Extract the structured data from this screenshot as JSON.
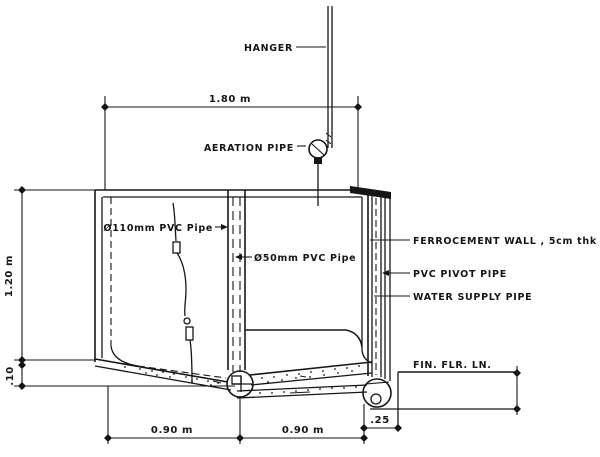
{
  "drawing": {
    "labels": {
      "hanger": "HANGER",
      "aeration_pipe": "AERATION PIPE",
      "pipe_110mm": "Ø110mm PVC Pipe",
      "pipe_50mm": "Ø50mm PVC Pipe",
      "ferrocement_wall": "FERROCEMENT WALL , 5cm thk",
      "pvc_pivot_pipe": "PVC PIVOT PIPE",
      "water_supply_pipe": "WATER SUPPLY PIPE",
      "finish_floor_line": "FIN. FLR. LN."
    },
    "dimensions": {
      "overall_width": "1.80 m",
      "tank_height": "1.20 m",
      "floor_drop": ".10",
      "left_half_width": "0.90 m",
      "right_half_width": "0.90 m",
      "wall_offset": ".25"
    },
    "colors": {
      "ink": "#161616",
      "paper": "#ffffff"
    }
  }
}
